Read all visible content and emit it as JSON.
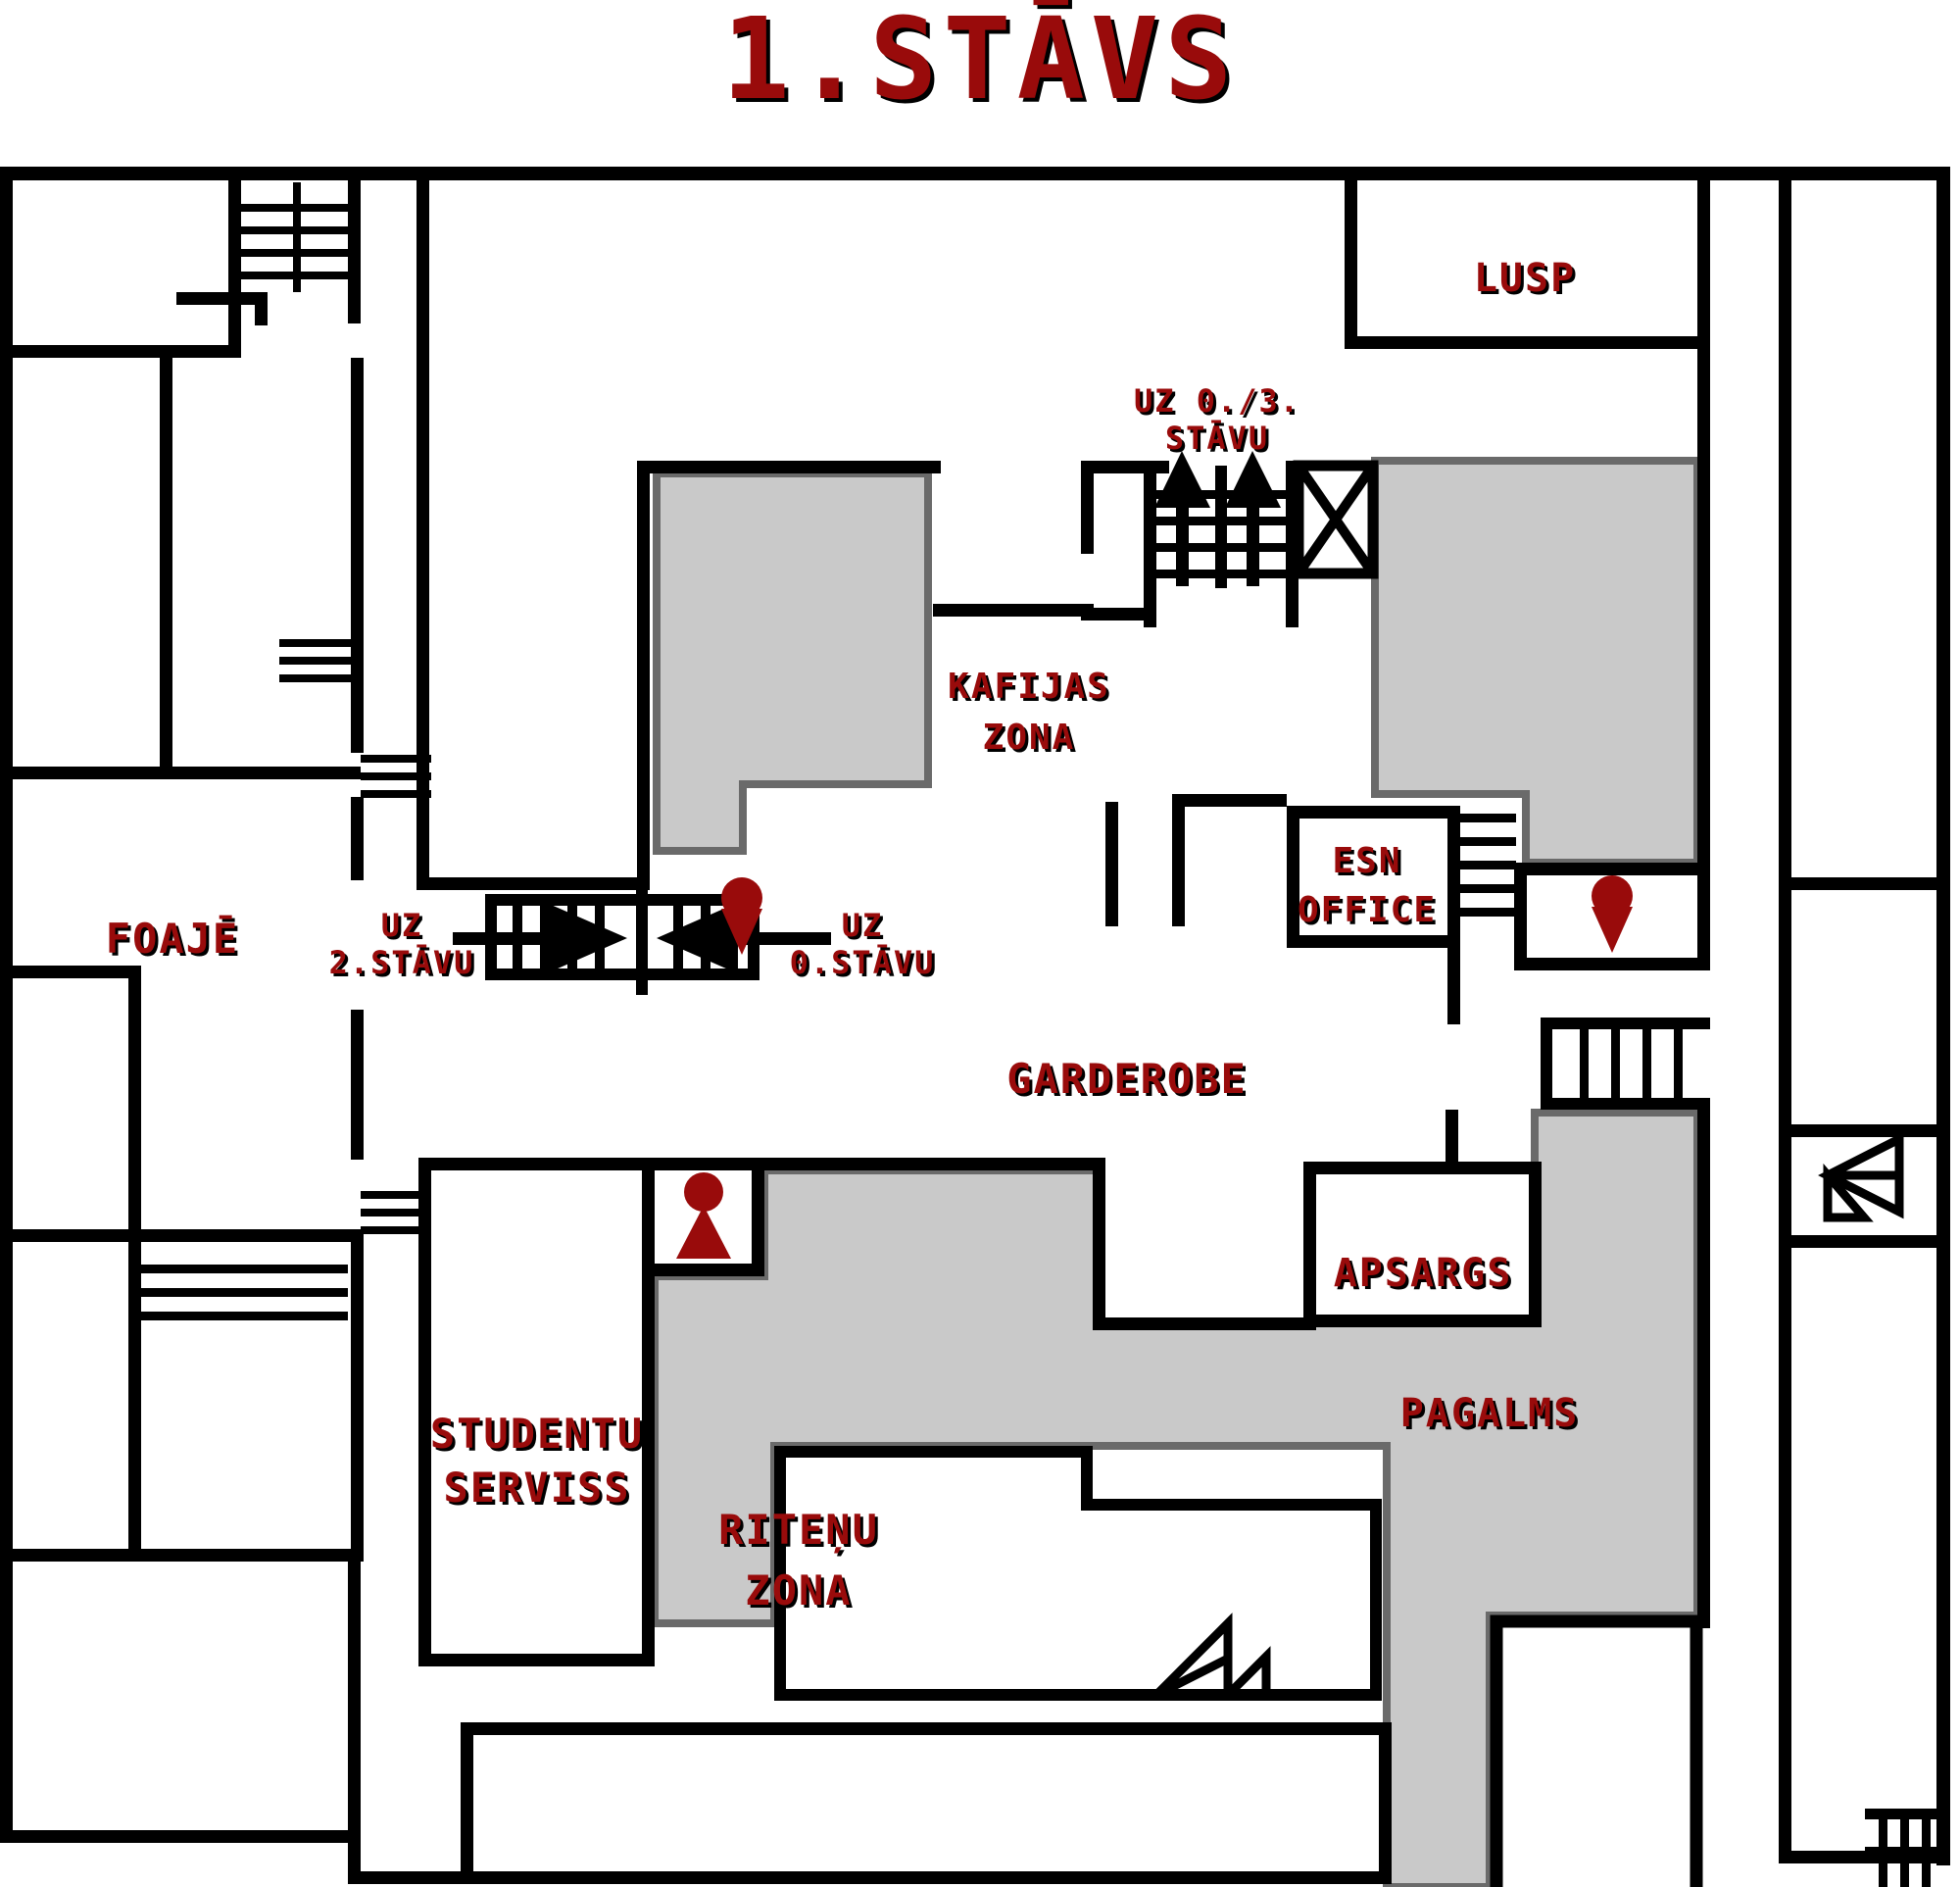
{
  "title": "1.STĀVS",
  "colors": {
    "accent_red": "#990B0B",
    "wall_black": "#000000",
    "zone_fill": "#C9C9C9",
    "zone_border": "#6A6A6A",
    "background": "#FFFFFF"
  },
  "rooms": {
    "lusp": {
      "label": "LUSP"
    },
    "kafijas_zona": {
      "label_line1": "KAFIJAS",
      "label_line2": "ZONA"
    },
    "esn_office": {
      "label_line1": "ESN",
      "label_line2": "OFFICE"
    },
    "foaje": {
      "label": "FOAJĒ"
    },
    "garderobe": {
      "label": "GARDEROBE"
    },
    "apsargs": {
      "label": "APSARGS"
    },
    "studentu_serviss": {
      "label_line1": "STUDENTU",
      "label_line2": "SERVISS"
    },
    "ritenu_zona": {
      "label_line1": "RITEŅU",
      "label_line2": "ZONA"
    },
    "pagalms": {
      "label": "PAGALMS"
    }
  },
  "stairs": {
    "to_0_3": {
      "label_line1": "UZ 0./3.",
      "label_line2": "STĀVU"
    },
    "to_2nd": {
      "label_line1": "UZ",
      "label_line2": "2.STĀVU"
    },
    "to_0th": {
      "label_line1": "UZ",
      "label_line2": "0.STĀVU"
    }
  },
  "icons": {
    "person": "person-icon",
    "location_pin": "location-pin-icon",
    "up_arrow": "up-arrow-icon",
    "right_arrow": "right-arrow-icon",
    "left_arrow": "left-arrow-icon",
    "elevator": "elevator-x-icon",
    "entrance_door": "entrance-door-icon",
    "stairs": "stairs-icon"
  }
}
